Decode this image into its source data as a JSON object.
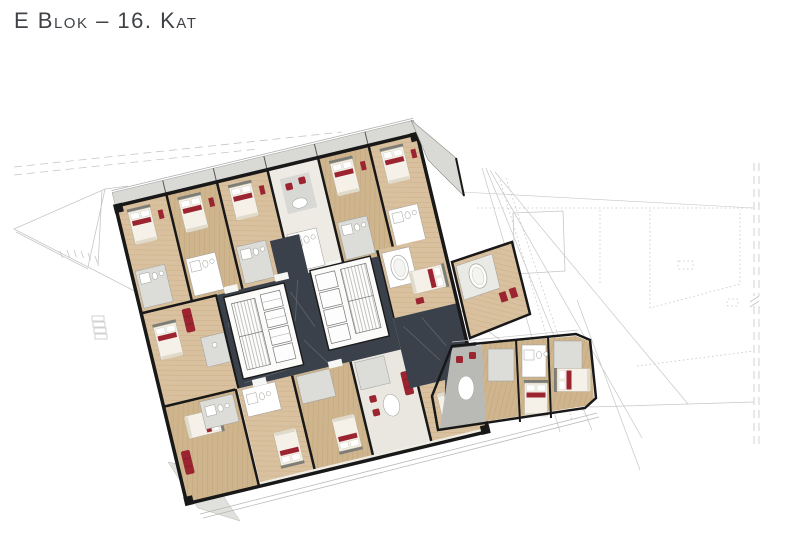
{
  "title": "E Blok – 16. Kat",
  "palette": {
    "title_text": "#3f4347",
    "wall": "#181818",
    "corridor": "#3a414b",
    "accent_red": "#9b2430",
    "bath_gray": "#dcdcd9",
    "balcony_gray": "#d9d9d6",
    "living_gray": "#b9b9b5",
    "outline_gray": "#c6c6c6",
    "core_white": "#fbfbfa",
    "wood": "#d9c19f",
    "wood_dark": "#cfb58e"
  }
}
